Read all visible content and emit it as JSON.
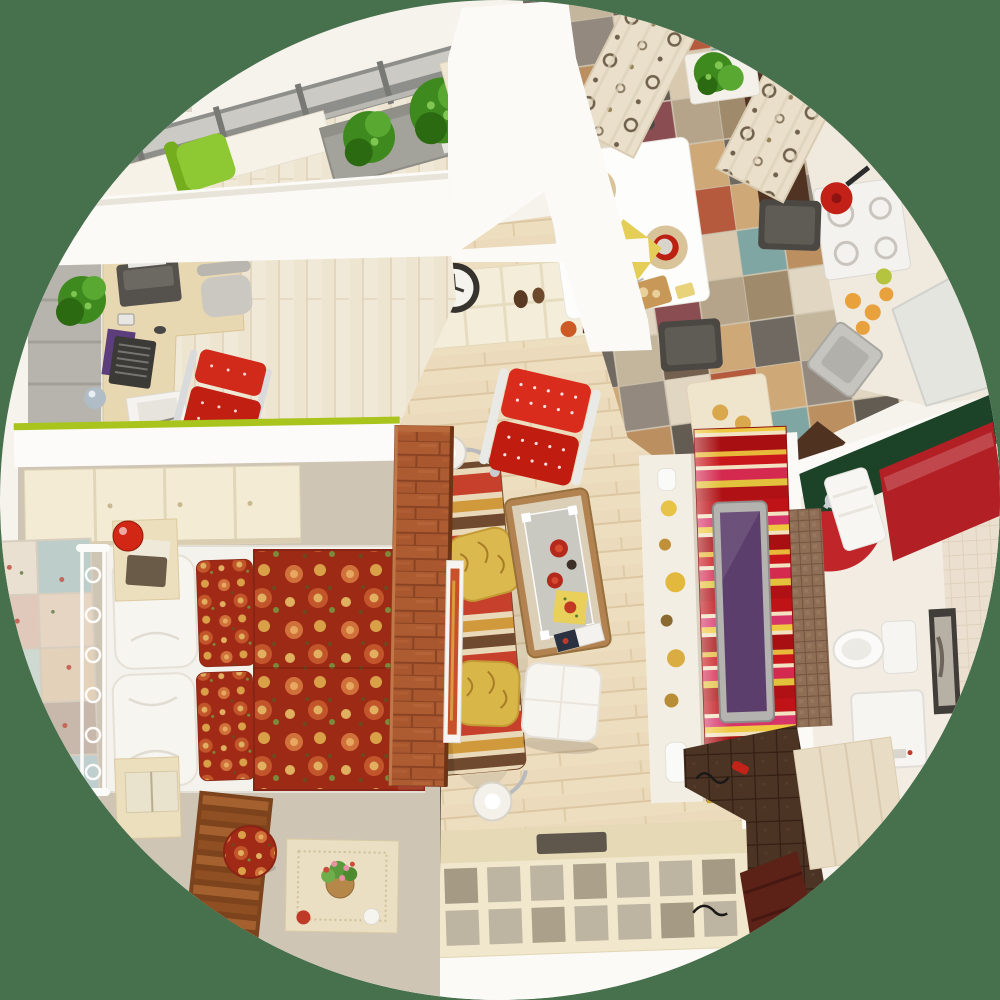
{
  "scene": {
    "title": "Top-down 3D render of a small studio apartment floor plan, cropped in a circle on a green background",
    "type": "3d-floor-plan-render",
    "view": "top-down",
    "frame_shape": "circle",
    "background_color": "#47704d"
  },
  "palette": {
    "background_green": "#47704d",
    "wall_white": "#fbfaf7",
    "floor_wood": "#eddec0",
    "floor_pale": "#f1e9d8",
    "carpet_beige": "#cfc5b5",
    "brick_orange": "#a8572e",
    "accent_lime": "#a9c41d",
    "sofa_red": "#c7402b",
    "sofa_gold": "#d09a3c",
    "sofa_brown": "#6f4a2e",
    "chair_red": "#d12a1b",
    "duvet_floral_red": "#a02a16",
    "curtain_cream": "#eadfca",
    "kitchen_tile_colors": [
      "#cfa878",
      "#93897e",
      "#e0d6c2",
      "#b65a3e",
      "#7fa6a2",
      "#bb8f60",
      "#635c52",
      "#d9c9ae",
      "#a08a6c",
      "#8a4e52",
      "#b5a489",
      "#6f6962",
      "#c4b69c",
      "#74604e"
    ],
    "tv_wall_red": "#c8161b",
    "tv_wall_pink": "#d6356a",
    "tv_wall_yellow": "#eec83e",
    "tv_screen_purple": "#5c3e6c",
    "bath_counter_green": "#1c4228",
    "bath_cabinet_red": "#b22026",
    "hall_tile_brown": "#4c3424",
    "plant_green": "#4e9a28",
    "planter_gray": "#a3a29b",
    "lamp_red": "#d32715",
    "wood_dark_cabinet": "#503322"
  },
  "rooms": {
    "balcony": {
      "label": "Balcony with plants and green chair",
      "items": [
        "window glazing",
        "potted plant on sill",
        "gray planter box with two green bushes",
        "lime green chair",
        "cream cabinet block"
      ]
    },
    "home_office": {
      "label": "Home office nook",
      "items": [
        "gray wardrobe",
        "wooden desk",
        "laptop",
        "purple mouse pad",
        "printer",
        "desk chair",
        "red side chair",
        "papers",
        "potted plant",
        "sphere lamp"
      ]
    },
    "kitchen": {
      "label": "Kitchen and dining area",
      "items": [
        "multicolor checkered tile floor",
        "polka-dot curtains",
        "window plant box",
        "white dining table",
        "red plates with food",
        "yellow runner with vegetables",
        "cutting board with bread",
        "dark dining chairs",
        "tall dark cabinet",
        "gas cooktop with red pot",
        "fruit on counter",
        "corner sink",
        "white cabinets",
        "bar counter with pastries"
      ]
    },
    "living_room": {
      "label": "Living room",
      "items": [
        "striped sofa",
        "yellow cushions",
        "two floor lamps",
        "red tufted lounge chair",
        "coffee table with glass top and plates",
        "white pouf",
        "cream wall shelf",
        "wall clock",
        "decor vases and books"
      ]
    },
    "bedroom": {
      "label": "Bedroom",
      "items": [
        "double bed with floral duvet",
        "white pillows",
        "floral pillows",
        "wrought-iron headboard",
        "patchwork wall panel",
        "two nightstands",
        "red table lamps",
        "wooden slat bench",
        "floral ottoman",
        "side table with flower basket",
        "brick partition wall",
        "leaning picture frame"
      ]
    },
    "bathroom": {
      "label": "Bathroom",
      "items": [
        "dark green counter with faucet",
        "red glossy cabinet",
        "curved red sink counter",
        "white towel",
        "mosaic tile wall",
        "toilet",
        "water heater boiler",
        "framed picture",
        "light tile wall"
      ]
    },
    "hallway": {
      "label": "Hallway and media wall",
      "items": [
        "red striped TV wall",
        "wall-mounted TV with purple screen",
        "white shelf with golden balls",
        "media shelving unit with glass cells",
        "black TV panel",
        "dark brown tile floor",
        "dark wood strip",
        "cream wardrobe",
        "red slipper",
        "wire decor"
      ]
    }
  }
}
